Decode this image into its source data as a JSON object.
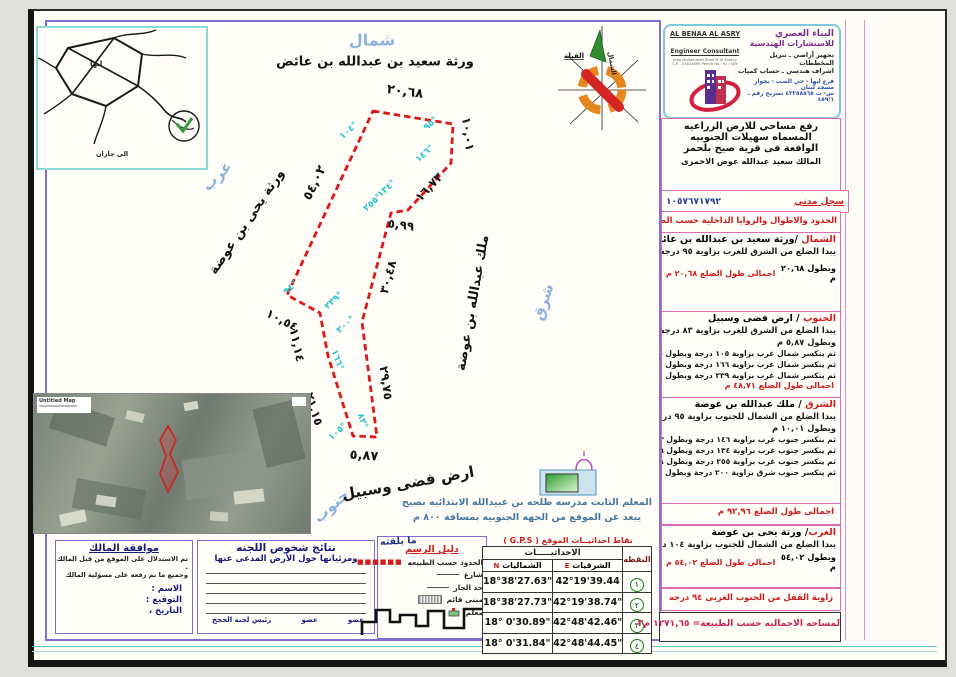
{
  "company": {
    "name_ar1": "البناء العصري",
    "name_ar2": "للاستشارات الهندسية",
    "svc1": "تجهير أراضي ـ تنزيل المخططات",
    "svc2": "اشراف هندسي ـ حساب كميات",
    "branch": "فرع ابها - حي الضب  -  بجوار مسجد لبنان",
    "phone": "س- ت  ٤٣٢٥٨٥٦٥  تصريح رقم ـ  ٤٥٩/١",
    "name_en": "AL BENAA AL ASRY",
    "sub_en": "Engineer Consultant",
    "small1": "prep Mohammed Zhair M Al Shehry",
    "small2": "C.R - 05825695    Permit No : 91 / 409"
  },
  "title_block": {
    "line1": "رفع مساحي للارض الزراعيه المسماه سهيلات الجنوبيه",
    "line2": "الواقعة فى قرية صيح بلحمر",
    "owner": "المالك سعيد عبدالله عوض الاحمرى",
    "civil_label": "سجل مدني",
    "civil_no": "١٠٥٧٦٧١٧٩٢",
    "bounds_header": "الحدود والاطوال والزوايا الداخلية حسب الطبيعة"
  },
  "sections": {
    "north": {
      "label": "الشمال",
      "name": "/ورثة سعيد بن عبدالله بن عائض",
      "line1": "يبدا الضلع من الشرق للغرب بزاوية ٩٥ درجه",
      "line2": "وبطول ٢٠,٦٨ م",
      "total": "اجمالى طول الضلع ٢٠,٦٨ م"
    },
    "south": {
      "label": "الجنوب",
      "name": "/ ارض فضى وسبيل",
      "line1": "يبدا الضلع من الشرق للغرب بزاوية ٨٣ درجه",
      "line2": "وبطول ٥,٨٧ م",
      "line3": "ثم ينكسر شمال غرب  بزاوية ١٠٥ درجة وبطول ٢١,١٥م",
      "line4": "ثم ينكسر شمال غرب  بزاوية ١٦٦ درجة وبطول ١١,١٤م",
      "line5": "ثم ينكسر شمال غرب  بزاوية ٢٣٩ درجة وبطول ١٠,٥٤م",
      "total": "اجمالى طول الضلع ٤٨,٧١ م"
    },
    "east": {
      "label": "الشرق",
      "name": "/ ملك عبدالله بن عوضة",
      "line1": "يبدا الضلع من الشمال للجنوب بزاوية ٩٥ درجه",
      "line2": "وبطول ١٠,٠١ م",
      "line3": "ثم ينكسر جنوب غرب بزاوية ١٤٦ درجة وبطول ١٦,٧٣م",
      "line4": "ثم ينكسر جنوب غرب بزاوية ١٣٤ درجة وبطول ٥,٩٩ م",
      "line5": "ثم ينكسر جنوب غرب بزاوية ٢٥٥ درجة وبطول ٣٠,٤٨ م",
      "line6": "ثم ينكسر جنوب شرق بزاوية ٢٠٠ درجة وبطول ٢٩,٧٥م",
      "total": "اجمالى طول الضلع ٩٢,٩٦  م"
    },
    "west": {
      "label": "الغرب",
      "name": "/ ورثة يحى بن عوضة",
      "line1": "يبدا الضلع من الشمال للجنوب بزاوية  ١٠٤ درجه",
      "line2": "وبطول  ٥٤,٠٢ م",
      "total": "اجمالى طول الضلع ٥٤,٠٢ م"
    }
  },
  "closing": {
    "lock_angle": "زاوية القفل من الجنوب الغربى   ٩٤  درجه",
    "total_area": "لمساحه الاجماليه حسب  الطبيعة=   ١٢٧١,٦٥ م٢"
  },
  "map": {
    "north_word": "شمال",
    "south_word": "جنوب",
    "east_word": "شرق",
    "west_word": "غرب",
    "north_neighbor": "ورثة سعيد بن عبدالله بن عائض",
    "west_neighbor": "ورثة يحى بن عوضة",
    "east_neighbor": "ملك عبدالله بن عوضة",
    "south_neighbor": "ارض فضى وسبيل",
    "lengths": {
      "top": "٢٠,٦٨",
      "right1": "١٠,٠١",
      "diag": "١٦,٧٣",
      "notch": "٥,٩٩",
      "mid": "٣٠,٤٨",
      "lower_right": "٢٩,٧٥",
      "bottom": "٥,٨٧",
      "s1": "٢١,١٥",
      "s2": "١١,١٤",
      "s3": "١٠,٥٤",
      "west": "٥٤,٠٢"
    },
    "angles": {
      "a104": "١٠٤°",
      "a95": "٩٥°",
      "a146": "١٤٦°",
      "a134": "١٣٤°",
      "a255": "٢٥٥°",
      "a200": "٢٠٠°",
      "a83": "٨٣°",
      "a105": "١٠٥°",
      "a166": "١٦٦°",
      "a239": "٢٣٩°",
      "a94": "٩٤°"
    },
    "compass": {
      "north": "الشمال",
      "qibla": "القبلة"
    },
    "sketch": {
      "city": "ابها",
      "to": "الى جازان"
    },
    "landmark": {
      "line1": "المعلم الثابت مدرسه طلحه بن عبيدالله الابتدائيه بصيح",
      "line2": "يبعد عن الموقع من الجهه الجنوبيه  بمسافة  ٨٠٠    م"
    },
    "satellite": {
      "label": "Untitled Map"
    }
  },
  "legend": {
    "title": "دليل الرسم",
    "overlay": "ما يلقته",
    "items": [
      "الحدود حسب الطبيعه",
      "شارع",
      "حد الجار",
      "مبنى قائم",
      "معلم"
    ]
  },
  "gps": {
    "title": "نقاط احداثيــات الموقع  ( G.P.S )",
    "col_point": "النقطه",
    "col_coords": "الاحداثيـــــات",
    "col_north": "الشماليات",
    "col_north_letter": "N",
    "col_east": "الشرقيات",
    "col_east_letter": "E",
    "rows": [
      {
        "point": "١",
        "east": "42°19'39.44",
        "north": "18°38'27.63\""
      },
      {
        "point": "٢",
        "east": "42°19'38.74\"",
        "north": "18°38'27.73\""
      },
      {
        "point": "٣",
        "east": "42°48'42.46\"",
        "north": "18° 0'30.89\""
      },
      {
        "point": "٤",
        "east": "42°48'44.45\"",
        "north": "18° 0'31.84\""
      }
    ]
  },
  "owner_box": {
    "title": "موافقة المالك",
    "line1": "تم الاستدلال على الموقع من قبل المالك .",
    "line2": "وجميع ما تم رفعه على مسؤلية المالك",
    "name_label": "الاسم   :",
    "sign_label": "التوقيع :",
    "date_label": "التاريخ  ،"
  },
  "committee_box": {
    "title": "نتائج شخوص اللجنه",
    "subtitle": "ومرئياتها حول الأرض المدعى عنها",
    "sig1": "عضو",
    "sig2": "عضو",
    "sig3": "رئيس لجنة الحجج"
  },
  "colors": {
    "parcel_red": "#dd1818",
    "angle_cyan": "#25c3cb",
    "border_pink": "#df6cb0",
    "border_violet": "#7f6fd2"
  }
}
